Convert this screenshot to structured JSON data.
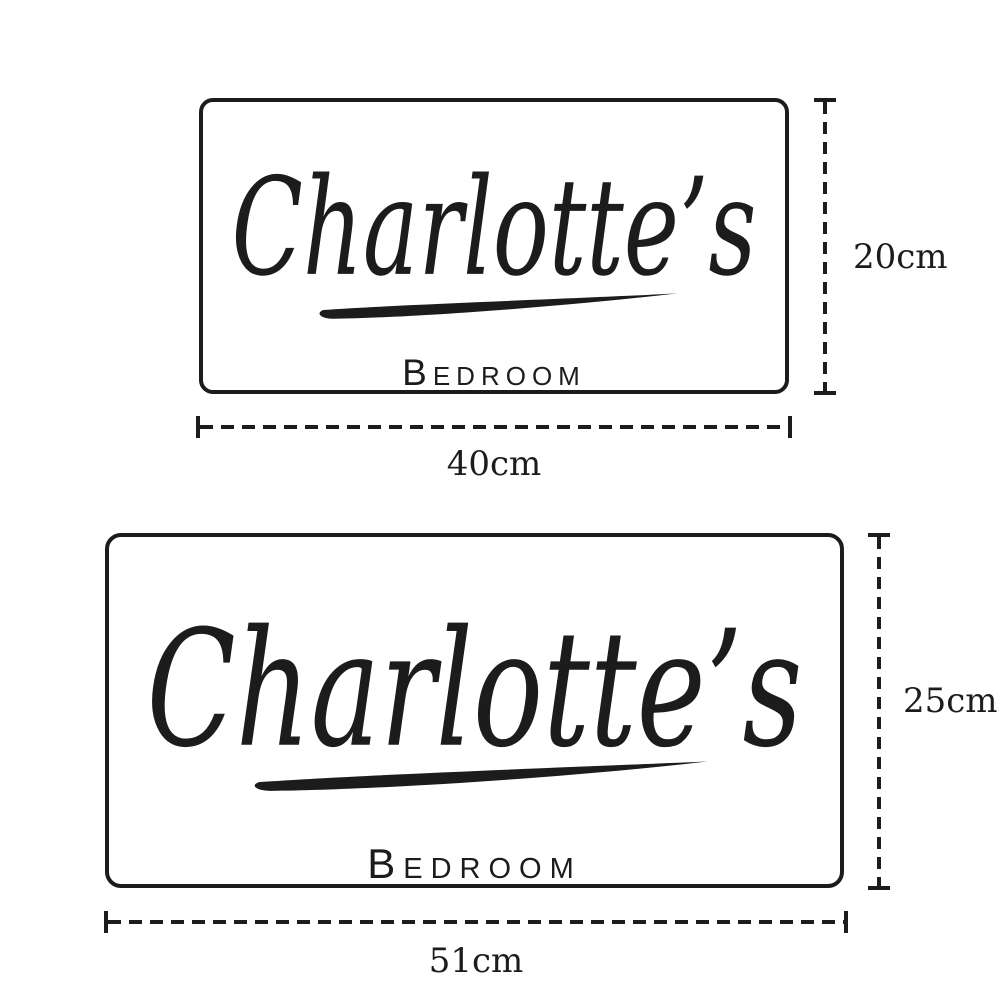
{
  "page": {
    "background": "#ffffff",
    "ink": "#1c1c1c"
  },
  "signs": [
    {
      "name": "Charlotte’s",
      "room_label": "Bedroom",
      "height_label": "20cm",
      "width_label": "40cm"
    },
    {
      "name": "Charlotte’s",
      "room_label": "Bedroom",
      "height_label": "25cm",
      "width_label": "51cm"
    }
  ]
}
